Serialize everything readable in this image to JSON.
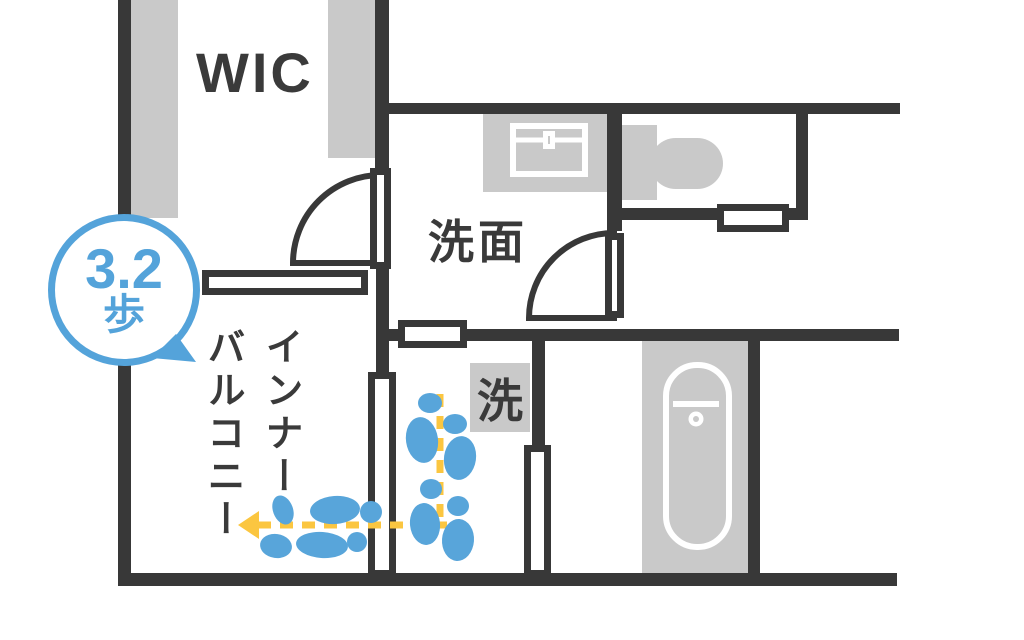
{
  "plan": {
    "title": "floor-plan-walking-distance-diagram",
    "rooms": {
      "wic": {
        "label": "WIC"
      },
      "washroom": {
        "label": "洗面"
      },
      "laundry": {
        "label": "洗"
      },
      "balcony": {
        "label": "インナーバルコニー",
        "label_line1": "インナー",
        "label_line2": "バルコニー"
      }
    },
    "annotation": {
      "steps_value": "3.2",
      "steps_unit": "歩"
    },
    "icons": {
      "fixtures": [
        "closet-shelf-icon",
        "sink-icon",
        "toilet-icon",
        "bathtub-icon",
        "washer-space"
      ],
      "symbols": [
        "door-swing-icon",
        "window-icon",
        "footprints-icon",
        "direction-arrow-icon",
        "speech-bubble-badge"
      ]
    },
    "colors": {
      "wall": "#383838",
      "fixture_gray": "#c9c9c9",
      "accent_blue": "#54a3da",
      "path_yellow": "#fbc640",
      "text_dark": "#3a3a3a",
      "background": "#ffffff"
    }
  }
}
